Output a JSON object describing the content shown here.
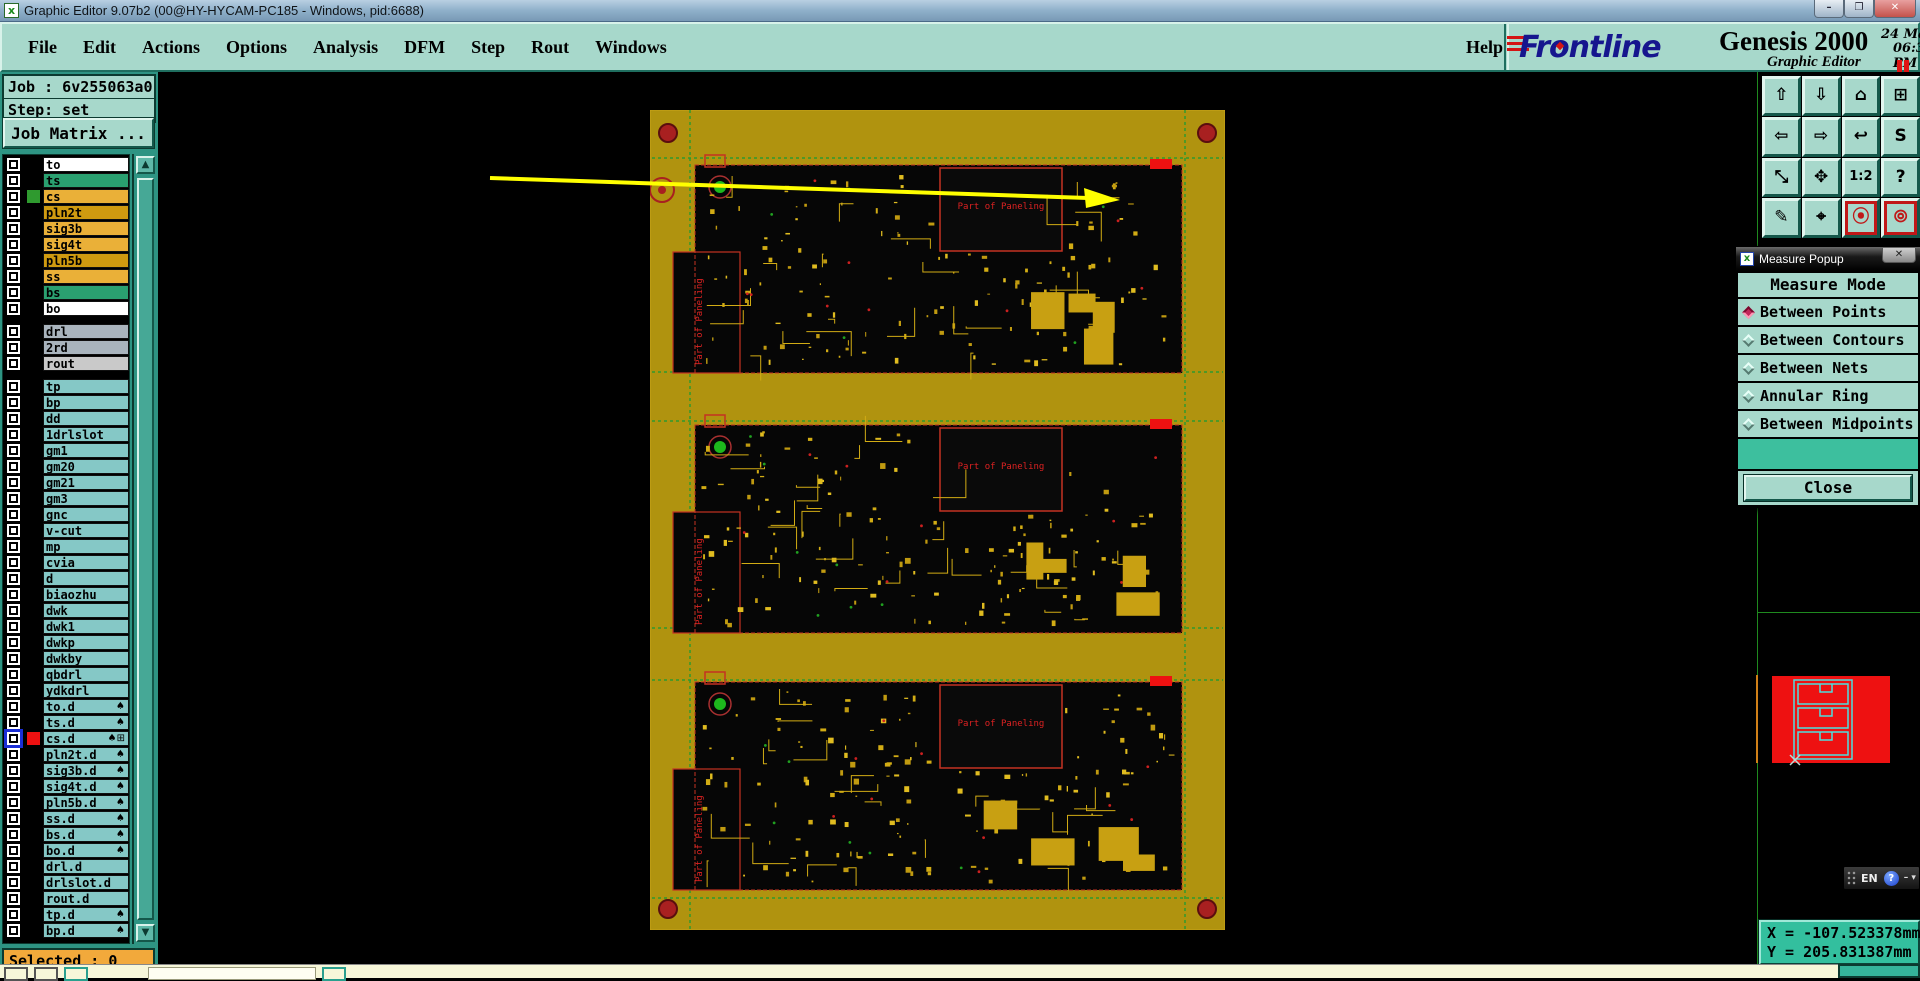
{
  "window": {
    "title": "Graphic Editor 9.07b2 (00@HY-HYCAM-PC185 - Windows, pid:6688)",
    "icon_glyph": "x",
    "minimize": "–",
    "restore": "❐",
    "close": "✕"
  },
  "menu": {
    "items": [
      "File",
      "Edit",
      "Actions",
      "Options",
      "Analysis",
      "DFM",
      "Step",
      "Rout",
      "Windows"
    ],
    "help": "Help"
  },
  "brand": {
    "logo": "Frontline",
    "product": "Genesis 2000",
    "subtitle": "Graphic Editor",
    "date": "24 May 2021",
    "time": "06:35 PM"
  },
  "job": {
    "job_label": "Job : 6v255063a0",
    "step_label": "Step: set",
    "matrix_button": "Job Matrix ..."
  },
  "layers": {
    "groups": [
      {
        "rows": [
          {
            "name": "to",
            "bg": "#ffffff"
          },
          {
            "name": "ts",
            "bg": "#2aa070"
          },
          {
            "name": "cs",
            "bg": "#eab038",
            "chip": "#2f9a2f"
          },
          {
            "name": "pln2t",
            "bg": "#cf9a10"
          },
          {
            "name": "sig3b",
            "bg": "#eab038"
          },
          {
            "name": "sig4t",
            "bg": "#eab038"
          },
          {
            "name": "pln5b",
            "bg": "#cf9a10"
          },
          {
            "name": "ss",
            "bg": "#eab038"
          },
          {
            "name": "bs",
            "bg": "#2aa070"
          },
          {
            "name": "bo",
            "bg": "#ffffff"
          }
        ]
      },
      {
        "rows": [
          {
            "name": "drl",
            "bg": "#a9b4bd"
          },
          {
            "name": "2rd",
            "bg": "#a9b4bd"
          },
          {
            "name": "rout",
            "bg": "#c9c9c9"
          }
        ]
      },
      {
        "rows": [
          {
            "name": "tp",
            "bg": "#85c8c6"
          },
          {
            "name": "bp",
            "bg": "#85c8c6"
          },
          {
            "name": "dd",
            "bg": "#85c8c6"
          },
          {
            "name": "1drlslot",
            "bg": "#85c8c6"
          },
          {
            "name": "gm1",
            "bg": "#85c8c6"
          },
          {
            "name": "gm20",
            "bg": "#85c8c6"
          },
          {
            "name": "gm21",
            "bg": "#85c8c6"
          },
          {
            "name": "gm3",
            "bg": "#85c8c6"
          },
          {
            "name": "gnc",
            "bg": "#85c8c6"
          },
          {
            "name": "v-cut",
            "bg": "#85c8c6"
          },
          {
            "name": "mp",
            "bg": "#85c8c6"
          },
          {
            "name": "cvia",
            "bg": "#85c8c6"
          },
          {
            "name": "d",
            "bg": "#85c8c6"
          },
          {
            "name": "biaozhu",
            "bg": "#85c8c6"
          },
          {
            "name": "dwk",
            "bg": "#85c8c6"
          },
          {
            "name": "dwk1",
            "bg": "#85c8c6"
          },
          {
            "name": "dwkp",
            "bg": "#85c8c6"
          },
          {
            "name": "dwkby",
            "bg": "#85c8c6"
          },
          {
            "name": "qbdrl",
            "bg": "#85c8c6"
          },
          {
            "name": "ydkdrl",
            "bg": "#85c8c6"
          },
          {
            "name": "to.d",
            "bg": "#85c8c6",
            "spade": true
          },
          {
            "name": "ts.d",
            "bg": "#85c8c6",
            "spade": true
          },
          {
            "name": "cs.d",
            "bg": "#85c8c6",
            "spade": true,
            "extra": true,
            "chip": "#ee1111",
            "highlight": true
          },
          {
            "name": "pln2t.d",
            "bg": "#85c8c6",
            "spade": true
          },
          {
            "name": "sig3b.d",
            "bg": "#85c8c6",
            "spade": true
          },
          {
            "name": "sig4t.d",
            "bg": "#85c8c6",
            "spade": true
          },
          {
            "name": "pln5b.d",
            "bg": "#85c8c6",
            "spade": true
          },
          {
            "name": "ss.d",
            "bg": "#85c8c6",
            "spade": true
          },
          {
            "name": "bs.d",
            "bg": "#85c8c6",
            "spade": true
          },
          {
            "name": "bo.d",
            "bg": "#85c8c6",
            "spade": true
          },
          {
            "name": "drl.d",
            "bg": "#85c8c6"
          },
          {
            "name": "drlslot.d",
            "bg": "#85c8c6"
          },
          {
            "name": "rout.d",
            "bg": "#85c8c6"
          },
          {
            "name": "tp.d",
            "bg": "#85c8c6",
            "spade": true
          },
          {
            "name": "bp.d",
            "bg": "#85c8c6",
            "spade": true
          }
        ]
      }
    ],
    "spade_glyph": "♠",
    "extra_glyph": "⊞",
    "scroll_up_glyph": "▲",
    "scroll_down_glyph": "▼"
  },
  "selected_label": "Selected : 0",
  "toolbar": {
    "buttons": [
      {
        "name": "pan-up",
        "glyph": "⇧"
      },
      {
        "name": "pan-down",
        "glyph": "⇩"
      },
      {
        "name": "home-view",
        "glyph": "⌂"
      },
      {
        "name": "window-xy",
        "glyph": "⊞"
      },
      {
        "name": "pan-left",
        "glyph": "⇦"
      },
      {
        "name": "pan-right",
        "glyph": "⇨"
      },
      {
        "name": "zoom-previous",
        "glyph": "↩"
      },
      {
        "name": "zoom-sequence",
        "glyph": "S"
      },
      {
        "name": "zoom-out",
        "glyph": "⤡"
      },
      {
        "name": "zoom-fit",
        "glyph": "✥"
      },
      {
        "name": "zoom-1-2",
        "glyph": "1:2"
      },
      {
        "name": "help-tool",
        "glyph": "?"
      },
      {
        "name": "setup-tools",
        "glyph": "✎"
      },
      {
        "name": "measure-probe",
        "glyph": "⌖"
      },
      {
        "name": "net-highlight",
        "glyph": "⦿",
        "active": true
      },
      {
        "name": "net-compare",
        "glyph": "⦾",
        "active": true
      }
    ]
  },
  "measure_popup": {
    "title": "Measure Popup",
    "icon_glyph": "x",
    "close_x": "✕",
    "header": "Measure Mode",
    "options": [
      {
        "label": "Between Points",
        "selected": true
      },
      {
        "label": "Between Contours",
        "selected": false
      },
      {
        "label": "Between Nets",
        "selected": false
      },
      {
        "label": "Annular Ring",
        "selected": false
      },
      {
        "label": "Between Midpoints",
        "selected": false
      }
    ],
    "close_button": "Close"
  },
  "coords": {
    "x": "X = -107.523378mm",
    "y": "Y = 205.831387mm"
  },
  "lang_bar": {
    "label": "EN",
    "help_glyph": "?",
    "min_glyph": "– ▾"
  },
  "canvas": {
    "panel_label": "Part of Paneling",
    "boards": [
      {
        "top": 55
      },
      {
        "top": 315
      },
      {
        "top": 572
      }
    ],
    "colors": {
      "rail": "#b0930f",
      "trace": "#d2ac14",
      "outline_red": "#c43222",
      "label_red": "#dd2222",
      "cut_green": "#2f9a2f",
      "arrow": "#ffff00",
      "thumb_red": "#ee1111",
      "thumb_cyan": "#4ce0e0"
    }
  }
}
